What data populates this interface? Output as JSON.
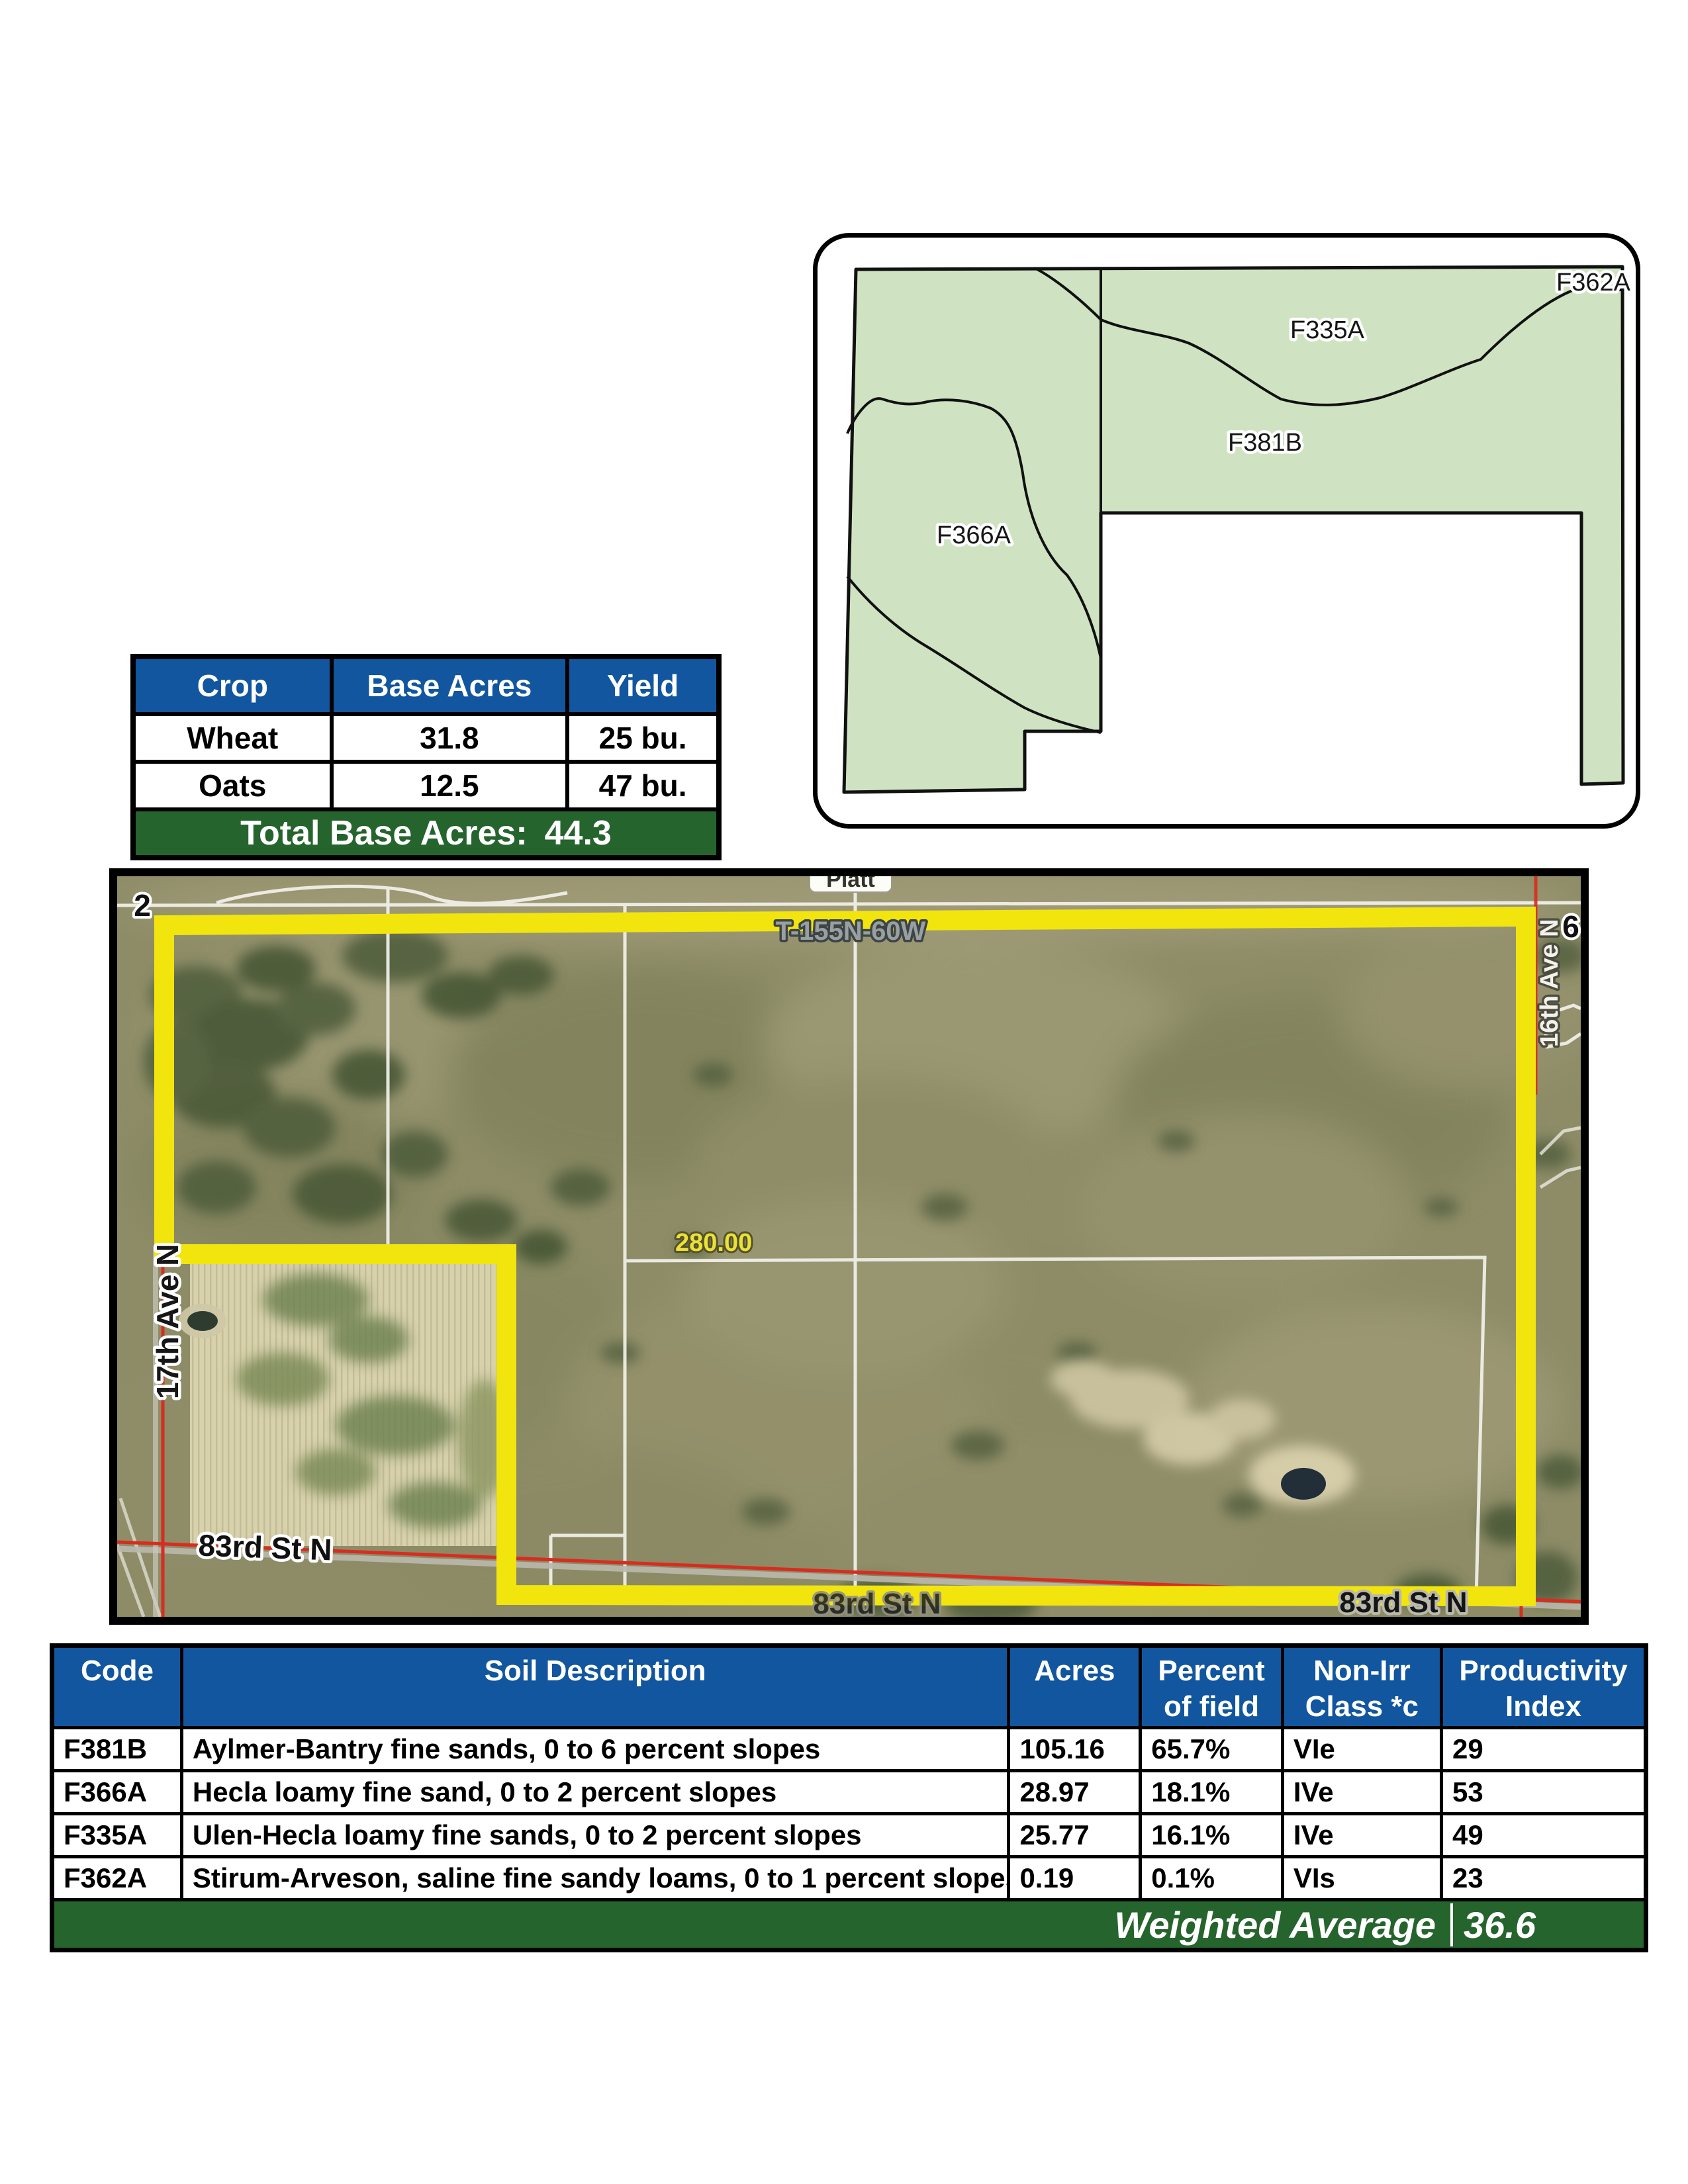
{
  "colors": {
    "header_blue": "#11569E",
    "bar_green": "#26642E",
    "map_green": "#CFE3C2",
    "boundary_yellow": "#F2E50D"
  },
  "crop_table": {
    "headers": [
      "Crop",
      "Base Acres",
      "Yield"
    ],
    "rows": [
      [
        "Wheat",
        "31.8",
        "25 bu."
      ],
      [
        "Oats",
        "12.5",
        "47 bu."
      ]
    ],
    "total_label": "Total Base Acres:",
    "total_value": "44.3"
  },
  "soil_map": {
    "region_labels": [
      "F362A",
      "F335A",
      "F381B",
      "F366A"
    ]
  },
  "aerial": {
    "section_nw": "2",
    "section_ne": "6",
    "town_sign": "Platt",
    "township": "T-155N-60W",
    "ave_right": "16th Ave N",
    "ave_left": "17th Ave N",
    "st_bottom_left": "83rd St N",
    "st_bottom_center": "83rd St N",
    "st_bottom_right": "83rd St N",
    "distance": "280.00"
  },
  "soil_table": {
    "headers": [
      [
        "Code",
        ""
      ],
      [
        "Soil Description",
        ""
      ],
      [
        "Acres",
        ""
      ],
      [
        "Percent",
        "of field"
      ],
      [
        "Non-Irr",
        "Class *c"
      ],
      [
        "Productivity",
        "Index"
      ]
    ],
    "rows": [
      [
        "F381B",
        "Aylmer-Bantry fine sands, 0 to 6 percent slopes",
        "105.16",
        "65.7%",
        "VIe",
        "29"
      ],
      [
        "F366A",
        "Hecla loamy fine sand, 0 to 2 percent slopes",
        "28.97",
        "18.1%",
        "IVe",
        "53"
      ],
      [
        "F335A",
        "Ulen-Hecla loamy fine sands, 0 to 2 percent slopes",
        "25.77",
        "16.1%",
        "IVe",
        "49"
      ],
      [
        "F362A",
        "Stirum-Arveson, saline fine sandy loams, 0 to 1 percent slopes",
        "0.19",
        "0.1%",
        "VIs",
        "23"
      ]
    ],
    "footer_label": "Weighted Average",
    "footer_value": "36.6"
  }
}
